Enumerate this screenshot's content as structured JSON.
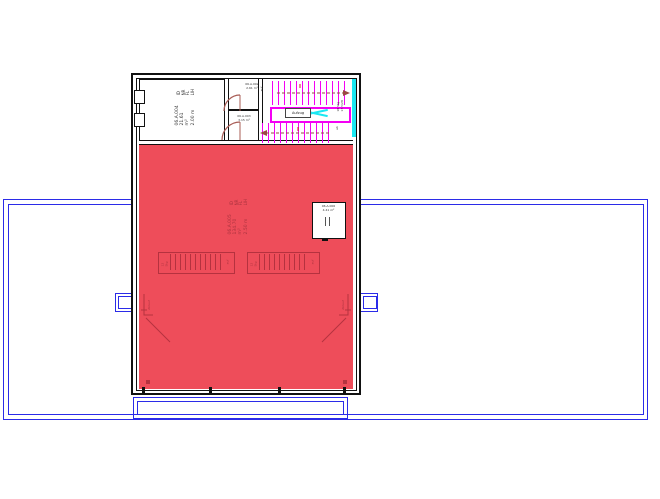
{
  "plan": {
    "rooms": {
      "nw_room_stamp": {
        "labels": "ID\nNR\nFL\nLIH",
        "values": "06.A.004\n21.61 m²\n2.00 m"
      },
      "closet_top_label": "06.A.002\n2.61 m²",
      "closet_bottom_label": "06.A.003\n3.15 m²",
      "hall_stamp": {
        "labels": "ID\nNR\nFL\nLIH",
        "values": "06.A.005\n134.70 m²\n2.50 m"
      },
      "east_room_label": "06.A.006\n4.41 m²"
    },
    "stair": {
      "landing_box": "Aufzug",
      "note_west": "auf",
      "note_east": "18 Stg\n17.5/28",
      "note_southeast": "ab"
    },
    "skylights": {
      "left_start": "12 Stg",
      "left_end": "auf",
      "right_start": "12 Stg",
      "right_end": "auf"
    },
    "corner_drains": {
      "left": "Ablauf",
      "right": "Ablauf"
    },
    "colors": {
      "site_blue": "#2b2be8",
      "wall_black": "#111111",
      "hall_red": "#ee4d5a",
      "detail_red": "#b5323f",
      "stair_magenta": "#f400f4",
      "lift_cyan": "#1ae8f2",
      "door_brown": "#a85c55"
    }
  }
}
